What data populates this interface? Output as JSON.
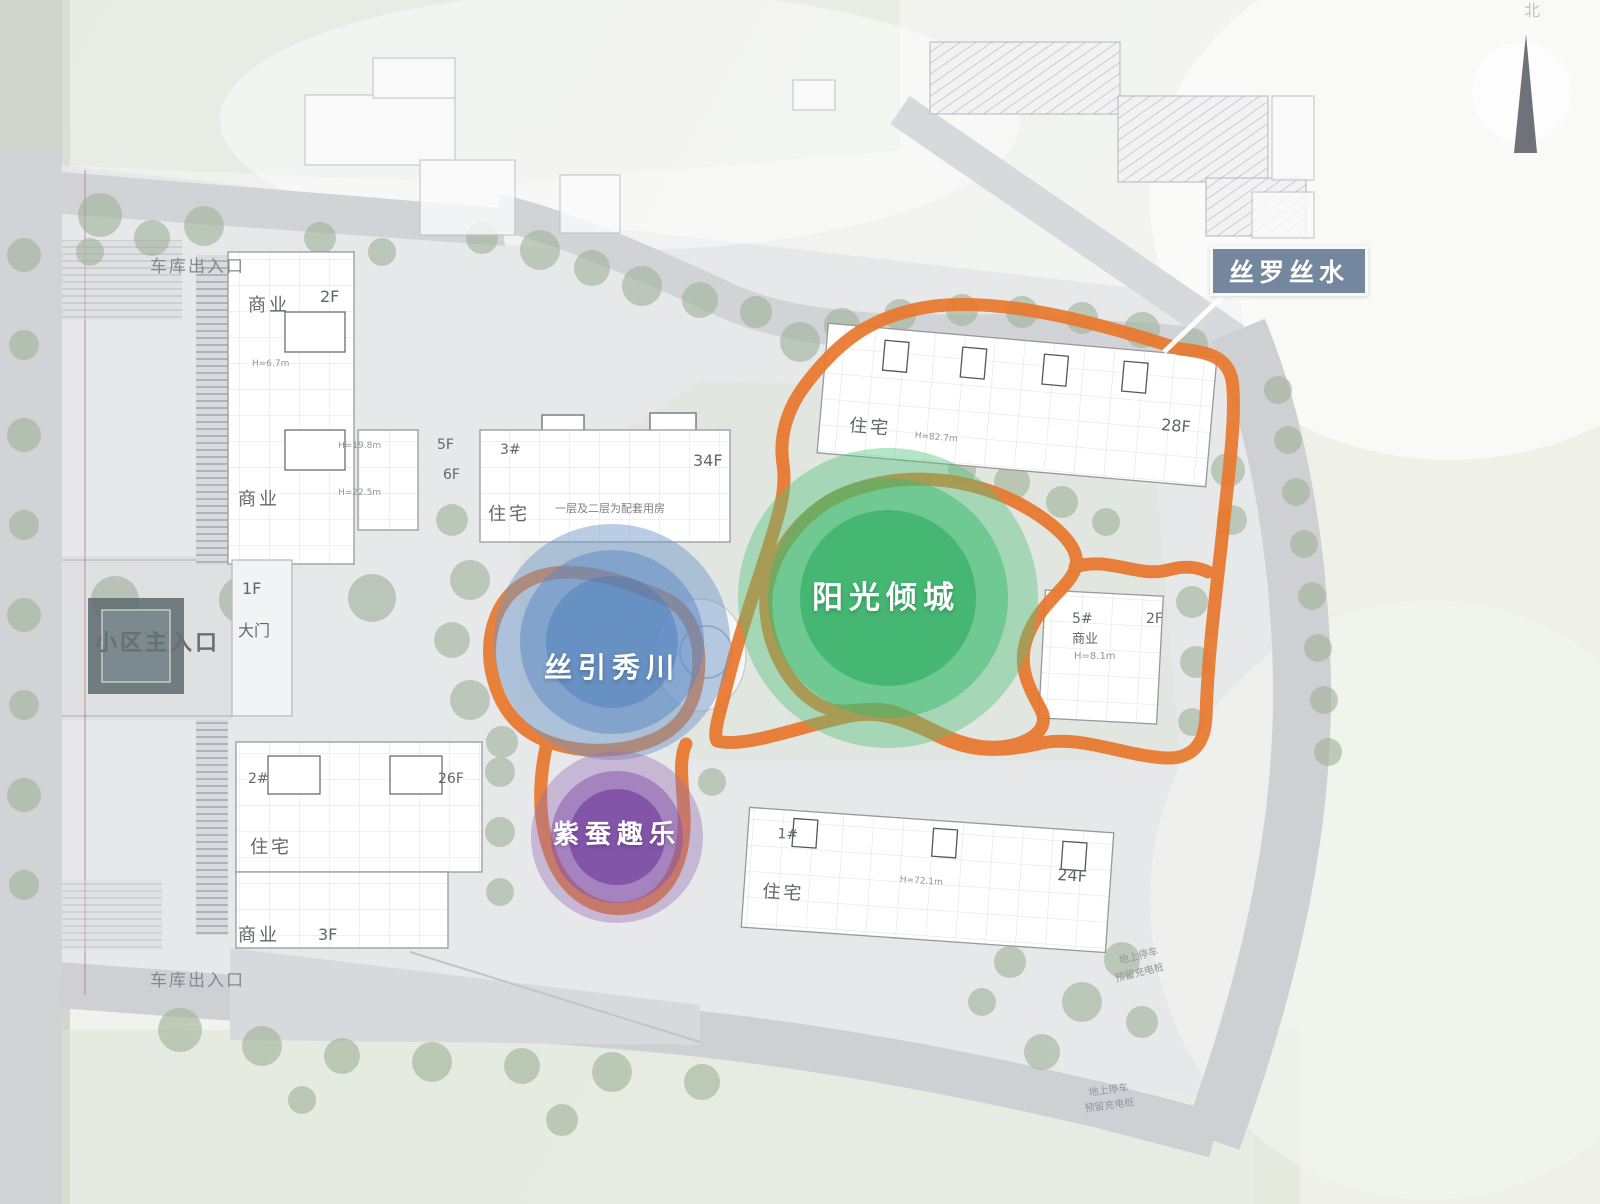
{
  "zones": {
    "silk_water": {
      "label": "丝罗丝水",
      "box_color": "#74879f"
    },
    "sunshine_city": {
      "label": "阳光倾城",
      "color": "#2fae5e"
    },
    "silk_stream": {
      "label": "丝引秀川",
      "color": "#5e8ec8"
    },
    "silkworm_fun": {
      "label": "紫蚕趣乐",
      "color": "#7d3f9e"
    },
    "loop_color": "#e8772c"
  },
  "entrances": {
    "garage_top": "车库出入口",
    "garage_bottom": "车库出入口",
    "main_gate": {
      "main": "小区主入口",
      "gate": "大门",
      "gate_floor": "1F"
    }
  },
  "buildings": {
    "west_retail": {
      "retail_upper": "商业",
      "floors_upper": "2F",
      "height_upper": "H=6.7m",
      "retail_lower": "商业"
    },
    "mid_block": {
      "num": "3#",
      "use": "住宅",
      "f5": "5F",
      "f6": "6F",
      "h1": "H=19.8m",
      "h2": "H=22.5m",
      "tower_floors": "34F",
      "note": "一层及二层为配套用房"
    },
    "northeast_block": {
      "use": "住宅",
      "height": "H=82.7m",
      "floors": "28F"
    },
    "east_retail": {
      "num": "5#",
      "floors": "2F",
      "use": "商业",
      "height": "H=8.1m"
    },
    "south_block": {
      "num": "1#",
      "use": "住宅",
      "height": "H=72.1m",
      "floors": "24F"
    },
    "southwest_block": {
      "num": "2#",
      "use": "住宅",
      "floors": "26F",
      "retail": "商业",
      "retail_floors": "3F"
    }
  },
  "notes": {
    "parking_east": {
      "line1": "地上停车",
      "line2": "预留充电桩"
    },
    "parking_south": {
      "line1": "地上停车",
      "line2": "预留充电桩"
    }
  },
  "compass": {
    "label": "北"
  }
}
